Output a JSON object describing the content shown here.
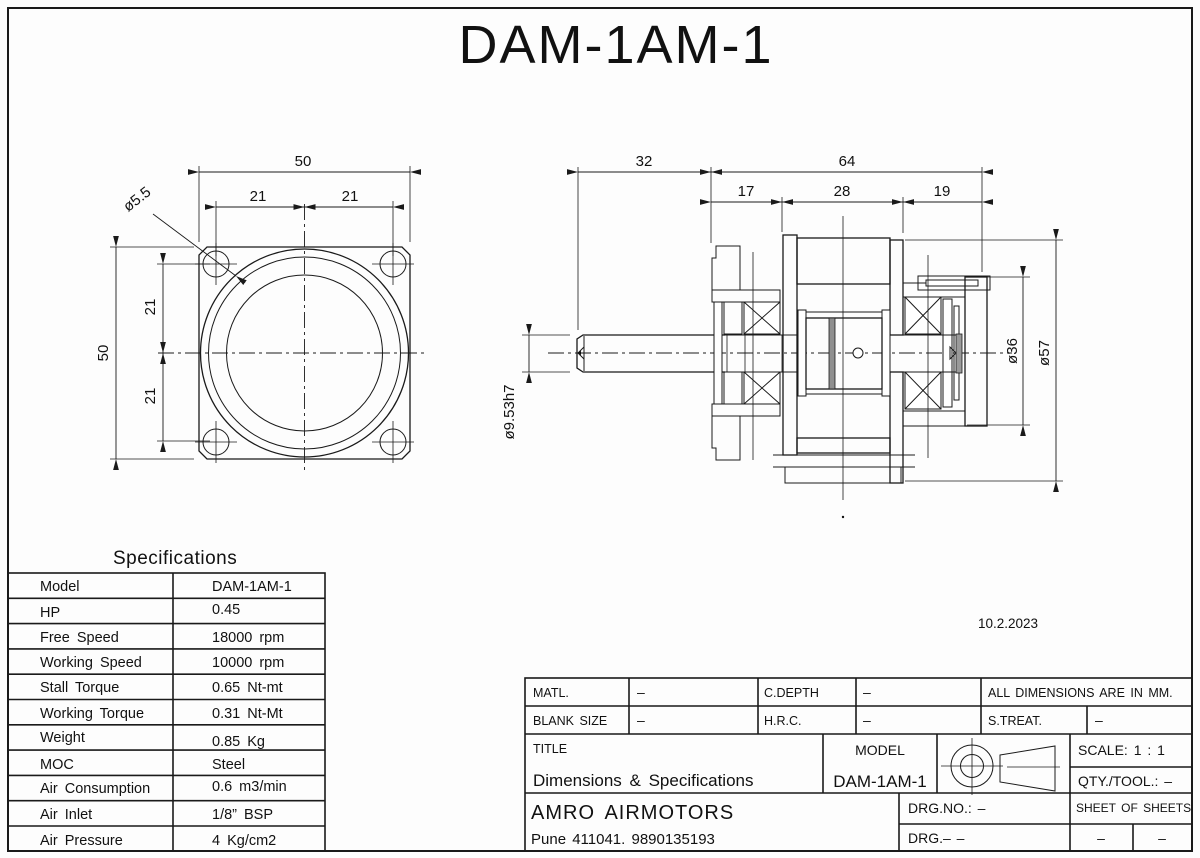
{
  "page": {
    "main_title": "DAM-1AM-1",
    "date": "10.2.2023"
  },
  "front_view": {
    "dim_width_top": "50",
    "dim_bolt_left": "21",
    "dim_bolt_right": "21",
    "dim_height_left": "50",
    "dim_bolt_top": "21",
    "dim_bolt_bottom": "21",
    "dim_hole": "ø5.5"
  },
  "section_view": {
    "dim_shaft_length": "32",
    "dim_body_length": "64",
    "dim_front": "17",
    "dim_middle": "28",
    "dim_rear": "19",
    "dim_shaft_dia": "ø9.53h7",
    "dim_rear_dia": "ø36",
    "dim_body_dia": "ø57"
  },
  "specifications": {
    "heading": "Specifications",
    "rows": [
      {
        "label": "Model",
        "value": "DAM-1AM-1"
      },
      {
        "label": "HP",
        "value": "0.45"
      },
      {
        "label": "Free Speed",
        "value": "18000 rpm"
      },
      {
        "label": "Working Speed",
        "value": "10000 rpm"
      },
      {
        "label": "Stall Torque",
        "value": "0.65 Nt-mt"
      },
      {
        "label": "Working Torque",
        "value": "0.31 Nt-Mt"
      },
      {
        "label": "Weight",
        "value": "0.85 Kg"
      },
      {
        "label": "MOC",
        "value": "Steel"
      },
      {
        "label": "Air Consumption",
        "value": "0.6 m3/min"
      },
      {
        "label": "Air Inlet",
        "value": "1/8” BSP"
      },
      {
        "label": "Air Pressure",
        "value": "4 Kg/cm2"
      }
    ]
  },
  "title_block": {
    "matl_label": "MATL.",
    "matl_value": "–",
    "cdepth_label": "C.DEPTH",
    "cdepth_value": "–",
    "all_dims_note": "ALL DIMENSIONS ARE IN MM.",
    "blank_size_label": "BLANK SIZE",
    "blank_size_value": "–",
    "hrc_label": "H.R.C.",
    "hrc_value": "–",
    "streat_label": "S.TREAT.",
    "streat_value": "–",
    "title_label": "TITLE",
    "title_value": "Dimensions & Specifications",
    "model_label": "MODEL",
    "model_value": "DAM-1AM-1",
    "scale_text": "SCALE: 1 : 1",
    "qty_text": "QTY./TOOL.: –",
    "company": "AMRO AIRMOTORS",
    "address": "Pune 411041. 9890135193",
    "drg_no_text": "DRG.NO.: –",
    "drg_text": "DRG.– –",
    "sheet_text": "SHEET OF SHEETS",
    "dash_left": "–",
    "dash_right": "–"
  }
}
